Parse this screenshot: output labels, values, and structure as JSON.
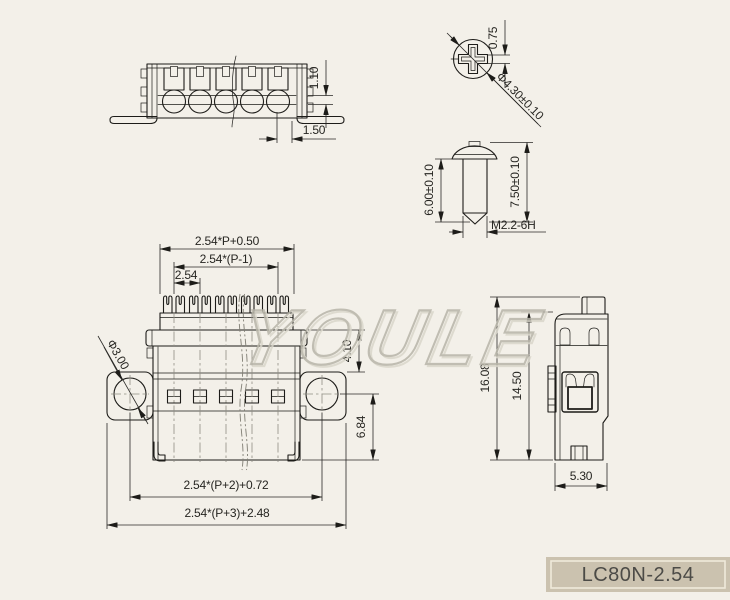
{
  "colors": {
    "bg": "#f3f0e9",
    "line": "#1d1c19",
    "dimline": "#2a2926",
    "dimtext": "#262521",
    "center": "#8f8d83",
    "wm1": "#b8b5a9",
    "wm2": "#dad7cb",
    "title_bg": "#cbc2af",
    "title_border": "#efe9da",
    "title_text": "#4c4b47"
  },
  "drawing": {
    "watermark": "YOULE",
    "title": "LC80N-2.54",
    "views": {
      "top": {
        "dims": {
          "slot_height": "1.10",
          "screw_edge": "1.50"
        }
      },
      "screw_head": {
        "dims": {
          "slot_width": "0.75",
          "head_dia": "Φ4.30±0.10"
        }
      },
      "screw_side": {
        "dims": {
          "thread_len": "6.00±0.10",
          "total_len": "7.50±0.10",
          "thread_spec": "M2.2-6H"
        }
      },
      "front": {
        "dims": {
          "top_width": "2.54*P+0.50",
          "pin_span": "2.54*(P-1)",
          "pitch": "2.54",
          "hole_dia": "Φ3.00",
          "cap_h": "4.10",
          "body_h": "6.84",
          "hole_span": "2.54*(P+2)+0.72",
          "total_width": "2.54*(P+3)+2.48"
        }
      },
      "side": {
        "dims": {
          "total_h": "16.08",
          "body_h": "14.50",
          "depth": "5.30"
        }
      }
    }
  }
}
